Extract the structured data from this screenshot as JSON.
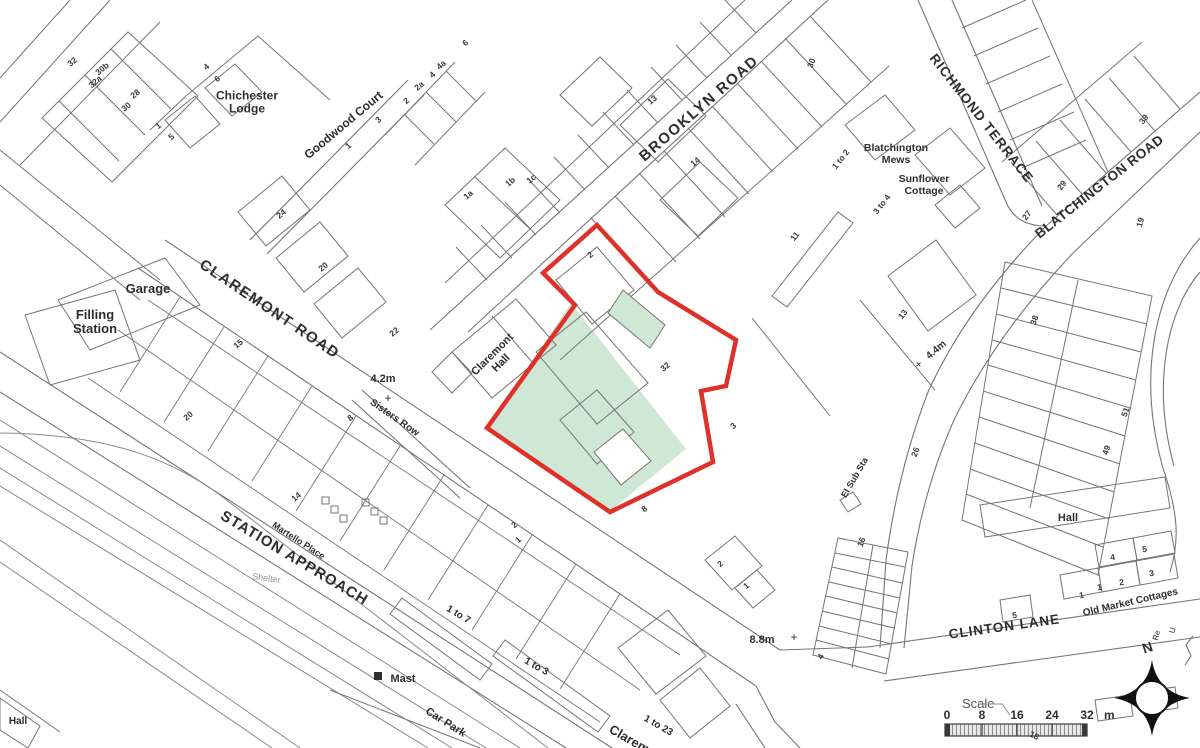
{
  "map": {
    "colors": {
      "line": "#757575",
      "line_light": "#8a8a8a",
      "boundary_red": "#df312a",
      "green_fill": "#cfe8d5",
      "text": "#2e2e2e",
      "muted_text": "#909090"
    },
    "scale_bar": {
      "label": "Scale",
      "ticks": [
        "0",
        "8",
        "16",
        "24",
        "32"
      ],
      "unit": "m"
    },
    "compass": {
      "north": "N"
    },
    "labels": [
      {
        "id": "brooklyn-road",
        "text": "BROOKLYN ROAD",
        "x": 702,
        "y": 112,
        "rot": -41,
        "size": 15,
        "bold": true,
        "sp": 1.5
      },
      {
        "id": "claremont-road",
        "text": "CLAREMONT ROAD",
        "x": 267,
        "y": 313,
        "rot": 34,
        "size": 15,
        "bold": true,
        "sp": 1.5
      },
      {
        "id": "station-approach",
        "text": "STATION APPROACH",
        "x": 292,
        "y": 562,
        "rot": 31,
        "size": 15,
        "bold": true,
        "sp": 1
      },
      {
        "id": "richmond-terrace",
        "text": "RICHMOND TERRACE",
        "x": 978,
        "y": 121,
        "rot": 52,
        "size": 13.5,
        "bold": true,
        "sp": 1
      },
      {
        "id": "blatchington-road",
        "text": "BLATCHINGTON ROAD",
        "x": 1102,
        "y": 190,
        "rot": -38,
        "size": 13.5,
        "bold": true,
        "sp": 0.5
      },
      {
        "id": "clinton-lane",
        "text": "CLINTON LANE",
        "x": 1005,
        "y": 631,
        "rot": -8,
        "size": 13.5,
        "bold": true,
        "sp": 1
      },
      {
        "id": "goodwood-court",
        "text": "Goodwood Court",
        "x": 346,
        "y": 128,
        "rot": -40,
        "size": 12,
        "bold": true
      },
      {
        "id": "chichester-lodge",
        "lines": [
          "Chichester",
          "Lodge"
        ],
        "x": 247,
        "y": 106,
        "rot": 0,
        "size": 12,
        "bold": true
      },
      {
        "id": "blatchington-mews",
        "lines": [
          "Blatchington",
          "Mews"
        ],
        "x": 896,
        "y": 157,
        "rot": 0,
        "size": 10.5,
        "bold": true
      },
      {
        "id": "sunflower-cottage",
        "lines": [
          "Sunflower",
          "Cottage"
        ],
        "x": 924,
        "y": 188,
        "rot": 0,
        "size": 10.5,
        "bold": true
      },
      {
        "id": "garage",
        "text": "Garage",
        "x": 148,
        "y": 293,
        "rot": 0,
        "size": 13,
        "bold": true
      },
      {
        "id": "filling-station",
        "lines": [
          "Filling",
          "Station"
        ],
        "x": 95,
        "y": 326,
        "rot": 0,
        "size": 13,
        "bold": true
      },
      {
        "id": "claremont-hall",
        "lines": [
          "Claremont",
          "Hall"
        ],
        "x": 499,
        "y": 361,
        "rot": -45,
        "size": 11,
        "bold": true
      },
      {
        "id": "height-4-2m",
        "text": "4.2m",
        "x": 383,
        "y": 382,
        "rot": 0,
        "size": 11,
        "bold": true
      },
      {
        "id": "plus-4-2",
        "text": "+",
        "x": 388,
        "y": 402,
        "rot": 0,
        "size": 12,
        "bold": false
      },
      {
        "id": "sisters-row",
        "text": "Sisters Row",
        "x": 393,
        "y": 420,
        "rot": 35,
        "size": 10,
        "bold": true
      },
      {
        "id": "martello-place",
        "text": "Martello Place",
        "x": 297,
        "y": 543,
        "rot": 33,
        "size": 9,
        "bold": true
      },
      {
        "id": "shelter",
        "text": "Shelter",
        "x": 266,
        "y": 581,
        "rot": 8,
        "size": 9,
        "bold": false,
        "color": "#909090"
      },
      {
        "id": "mast",
        "text": "Mast",
        "x": 403,
        "y": 682,
        "rot": 0,
        "size": 11,
        "bold": true
      },
      {
        "id": "car-park",
        "text": "Car Park",
        "x": 444,
        "y": 725,
        "rot": 32,
        "size": 11,
        "bold": true
      },
      {
        "id": "range-1-to-7",
        "text": "1 to 7",
        "x": 457,
        "y": 617,
        "rot": 31,
        "size": 10,
        "bold": true
      },
      {
        "id": "range-1-to-3",
        "text": "1 to 3",
        "x": 535,
        "y": 669,
        "rot": 29,
        "size": 10,
        "bold": true
      },
      {
        "id": "range-1-to-23",
        "text": "1 to 23",
        "x": 657,
        "y": 728,
        "rot": 30,
        "size": 10,
        "bold": true
      },
      {
        "id": "claremont-partial",
        "text": "Claremont",
        "x": 636,
        "y": 748,
        "rot": 30,
        "size": 13,
        "bold": true
      },
      {
        "id": "height-8-8m",
        "text": "8.8m",
        "x": 762,
        "y": 643,
        "rot": 0,
        "size": 11,
        "bold": true
      },
      {
        "id": "plus-8-8",
        "text": "+",
        "x": 794,
        "y": 641,
        "rot": 0,
        "size": 12,
        "bold": false
      },
      {
        "id": "el-sub-sta",
        "text": "El Sub Sta",
        "x": 857,
        "y": 479,
        "rot": -60,
        "size": 9,
        "bold": true
      },
      {
        "id": "height-4-4m",
        "text": "4.4m",
        "x": 938,
        "y": 352,
        "rot": -40,
        "size": 10,
        "bold": true
      },
      {
        "id": "plus-4-4",
        "text": "+",
        "x": 921,
        "y": 367,
        "rot": -40,
        "size": 11,
        "bold": false
      },
      {
        "id": "old-market-cottages",
        "text": "Old Market Cottages",
        "x": 1131,
        "y": 605,
        "rot": -13,
        "size": 10,
        "bold": true
      },
      {
        "id": "hall-east",
        "text": "Hall",
        "x": 1068,
        "y": 521,
        "rot": 0,
        "size": 11,
        "bold": true
      },
      {
        "id": "hall-southwest",
        "text": "Hall",
        "x": 18,
        "y": 724,
        "rot": 0,
        "size": 10,
        "bold": true
      },
      {
        "id": "partial-re",
        "text": "Re",
        "x": 1159,
        "y": 636,
        "rot": -75,
        "size": 8,
        "bold": false
      },
      {
        "id": "partial-u",
        "text": "U",
        "x": 1175,
        "y": 631,
        "rot": -75,
        "size": 8,
        "bold": false
      },
      {
        "id": "num-32",
        "text": "32",
        "x": 74,
        "y": 64,
        "rot": -40,
        "num": true
      },
      {
        "id": "num-30b",
        "text": "30b",
        "x": 104,
        "y": 71,
        "rot": -40,
        "num": true
      },
      {
        "id": "num-32a",
        "text": "32a",
        "x": 97,
        "y": 84,
        "rot": -40,
        "num": true
      },
      {
        "id": "num-28",
        "text": "28",
        "x": 137,
        "y": 96,
        "rot": -40,
        "num": true
      },
      {
        "id": "num-30-a",
        "text": "30",
        "x": 128,
        "y": 109,
        "rot": -40,
        "num": true
      },
      {
        "id": "num-4-a",
        "text": "4",
        "x": 208,
        "y": 69,
        "rot": -40,
        "num": true
      },
      {
        "id": "num-6-a",
        "text": "6",
        "x": 219,
        "y": 81,
        "rot": -40,
        "num": true
      },
      {
        "id": "num-1-a",
        "text": "1",
        "x": 160,
        "y": 128,
        "rot": -40,
        "num": true
      },
      {
        "id": "num-5-a",
        "text": "5",
        "x": 173,
        "y": 139,
        "rot": -40,
        "num": true
      },
      {
        "id": "num-1-gc",
        "text": "1",
        "x": 350,
        "y": 148,
        "rot": -40,
        "num": true
      },
      {
        "id": "num-3-gc",
        "text": "3",
        "x": 380,
        "y": 122,
        "rot": -40,
        "num": true
      },
      {
        "id": "num-2-gc",
        "text": "2",
        "x": 408,
        "y": 103,
        "rot": -40,
        "num": true
      },
      {
        "id": "num-2a-gc",
        "text": "2a",
        "x": 421,
        "y": 88,
        "rot": -40,
        "num": true
      },
      {
        "id": "num-4-gc",
        "text": "4",
        "x": 434,
        "y": 77,
        "rot": -40,
        "num": true
      },
      {
        "id": "num-4a-gc",
        "text": "4a",
        "x": 443,
        "y": 67,
        "rot": -40,
        "num": true
      },
      {
        "id": "num-6-top",
        "text": "6",
        "x": 467,
        "y": 45,
        "rot": -40,
        "num": true
      },
      {
        "id": "num-1a",
        "text": "1a",
        "x": 470,
        "y": 197,
        "rot": -40,
        "num": true
      },
      {
        "id": "num-1b",
        "text": "1b",
        "x": 512,
        "y": 184,
        "rot": -40,
        "num": true
      },
      {
        "id": "num-1c",
        "text": "1c",
        "x": 533,
        "y": 181,
        "rot": -40,
        "num": true
      },
      {
        "id": "num-13-br",
        "text": "13",
        "x": 654,
        "y": 102,
        "rot": -40,
        "num": true
      },
      {
        "id": "num-14-br",
        "text": "14",
        "x": 697,
        "y": 164,
        "rot": -40,
        "num": true
      },
      {
        "id": "num-30-br",
        "text": "30",
        "x": 814,
        "y": 64,
        "rot": -70,
        "num": true
      },
      {
        "id": "num-1to2",
        "text": "1 to 2",
        "x": 843,
        "y": 161,
        "rot": -52,
        "num": true
      },
      {
        "id": "num-3to4",
        "text": "3 to 4",
        "x": 884,
        "y": 206,
        "rot": -52,
        "num": true
      },
      {
        "id": "num-11",
        "text": "11",
        "x": 797,
        "y": 238,
        "rot": -52,
        "num": true
      },
      {
        "id": "num-13-e",
        "text": "13",
        "x": 905,
        "y": 316,
        "rot": -52,
        "num": true
      },
      {
        "id": "num-24",
        "text": "24",
        "x": 283,
        "y": 216,
        "rot": -40,
        "num": true
      },
      {
        "id": "num-20-cr",
        "text": "20",
        "x": 325,
        "y": 269,
        "rot": -40,
        "num": true
      },
      {
        "id": "num-22",
        "text": "22",
        "x": 396,
        "y": 334,
        "rot": -40,
        "num": true
      },
      {
        "id": "num-2-site",
        "text": "2",
        "x": 592,
        "y": 257,
        "rot": -40,
        "num": true
      },
      {
        "id": "num-32-site",
        "text": "32",
        "x": 667,
        "y": 369,
        "rot": -40,
        "num": true
      },
      {
        "id": "num-3-site",
        "text": "3",
        "x": 735,
        "y": 428,
        "rot": -40,
        "num": true
      },
      {
        "id": "num-8-site",
        "text": "8",
        "x": 646,
        "y": 511,
        "rot": -40,
        "num": true
      },
      {
        "id": "num-27",
        "text": "27",
        "x": 1029,
        "y": 217,
        "rot": -52,
        "num": true
      },
      {
        "id": "num-29",
        "text": "29",
        "x": 1064,
        "y": 187,
        "rot": -52,
        "num": true
      },
      {
        "id": "num-39",
        "text": "39",
        "x": 1146,
        "y": 121,
        "rot": -52,
        "num": true
      },
      {
        "id": "num-19",
        "text": "19",
        "x": 1143,
        "y": 223,
        "rot": -75,
        "num": true
      },
      {
        "id": "num-38",
        "text": "38",
        "x": 1037,
        "y": 321,
        "rot": -70,
        "num": true
      },
      {
        "id": "num-51",
        "text": "51",
        "x": 1128,
        "y": 413,
        "rot": -70,
        "num": true
      },
      {
        "id": "num-49",
        "text": "49",
        "x": 1109,
        "y": 451,
        "rot": -70,
        "num": true
      },
      {
        "id": "num-26",
        "text": "26",
        "x": 918,
        "y": 453,
        "rot": -70,
        "num": true
      },
      {
        "id": "num-16",
        "text": "16",
        "x": 864,
        "y": 543,
        "rot": -70,
        "num": true
      },
      {
        "id": "num-15",
        "text": "15",
        "x": 240,
        "y": 346,
        "rot": -40,
        "num": true
      },
      {
        "id": "num-20-w",
        "text": "20",
        "x": 190,
        "y": 418,
        "rot": -40,
        "num": true
      },
      {
        "id": "num-8-w",
        "text": "8",
        "x": 352,
        "y": 420,
        "rot": -40,
        "num": true
      },
      {
        "id": "num-14-w",
        "text": "14",
        "x": 298,
        "y": 499,
        "rot": -40,
        "num": true
      },
      {
        "id": "num-2-sw",
        "text": "2",
        "x": 516,
        "y": 527,
        "rot": -40,
        "num": true
      },
      {
        "id": "num-1-sw",
        "text": "1",
        "x": 520,
        "y": 542,
        "rot": -40,
        "num": true
      },
      {
        "id": "num-2-s",
        "text": "2",
        "x": 722,
        "y": 566,
        "rot": -40,
        "num": true
      },
      {
        "id": "num-1-s",
        "text": "1",
        "x": 748,
        "y": 588,
        "rot": -40,
        "num": true
      },
      {
        "id": "num-4-s",
        "text": "4",
        "x": 823,
        "y": 658,
        "rot": -60,
        "num": true
      },
      {
        "id": "num-1-cl-a",
        "text": "1",
        "x": 1082,
        "y": 598,
        "rot": -8,
        "num": true
      },
      {
        "id": "num-1-cl-b",
        "text": "1",
        "x": 1100,
        "y": 590,
        "rot": -8,
        "num": true
      },
      {
        "id": "num-2-cl",
        "text": "2",
        "x": 1122,
        "y": 585,
        "rot": -8,
        "num": true
      },
      {
        "id": "num-3-cl",
        "text": "3",
        "x": 1152,
        "y": 576,
        "rot": -8,
        "num": true
      },
      {
        "id": "num-4-cl",
        "text": "4",
        "x": 1113,
        "y": 560,
        "rot": -8,
        "num": true
      },
      {
        "id": "num-5-cl",
        "text": "5",
        "x": 1145,
        "y": 552,
        "rot": -8,
        "num": true
      },
      {
        "id": "num-5-cl2",
        "text": "5",
        "x": 1015,
        "y": 618,
        "rot": -8,
        "num": true
      },
      {
        "id": "num-18",
        "text": "18",
        "x": 1033,
        "y": 738,
        "rot": 25,
        "num": true
      }
    ]
  }
}
